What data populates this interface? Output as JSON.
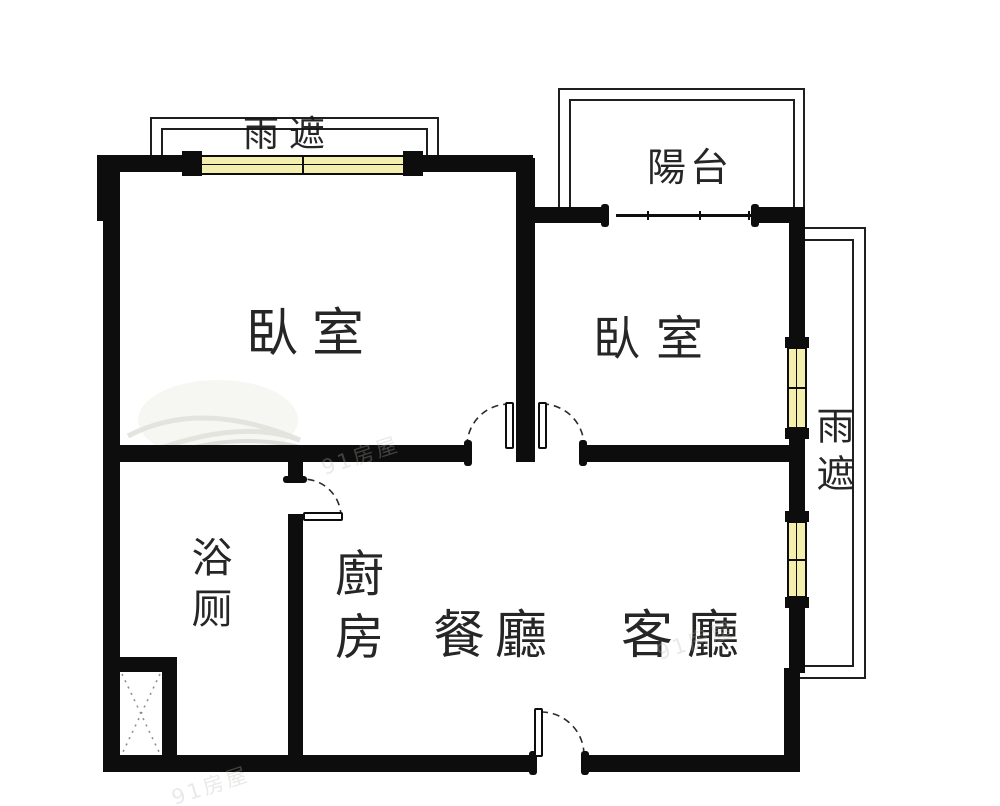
{
  "colors": {
    "wall": "#0d0d0d",
    "line": "#1f1f1f",
    "window_fill": "#f5efad",
    "text": "#141414",
    "watermark": "#b9b8b2"
  },
  "labels": {
    "rain_shelter_top": {
      "text": "雨遮"
    },
    "balcony": {
      "text": "陽台"
    },
    "bedroom_left": {
      "text": "臥室"
    },
    "bedroom_right": {
      "text": "臥室"
    },
    "bathroom": {
      "text": "浴厕"
    },
    "kitchen": {
      "text": "廚房"
    },
    "dining": {
      "text": "餐廳"
    },
    "living": {
      "text": "客廳"
    },
    "rain_shelter_right": {
      "text": "雨遮"
    }
  },
  "watermark": {
    "text": "91房屋"
  }
}
